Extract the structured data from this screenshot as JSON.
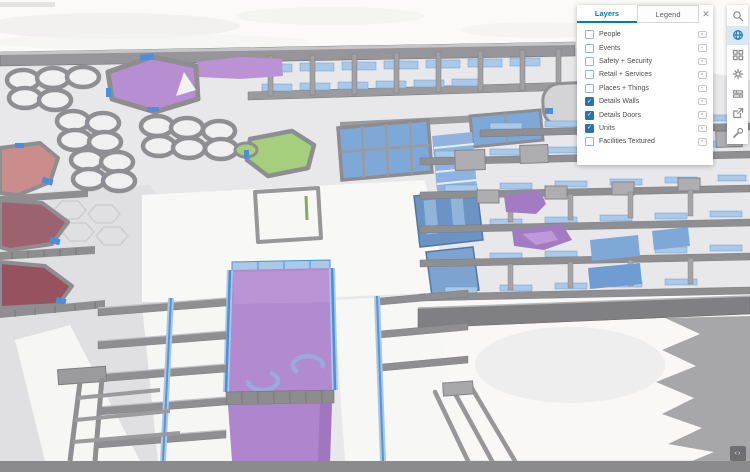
{
  "panel": {
    "tabs": [
      {
        "label": "Layers",
        "active": true
      },
      {
        "label": "Legend",
        "active": false
      }
    ],
    "close_label": "✕",
    "row_icon_name": "layer-options-icon",
    "layers": [
      {
        "label": "People",
        "checked": false
      },
      {
        "label": "Events",
        "checked": false
      },
      {
        "label": "Safety + Security",
        "checked": false
      },
      {
        "label": "Retail + Services",
        "checked": false
      },
      {
        "label": "Places + Things",
        "checked": false
      },
      {
        "label": "Details Walls",
        "checked": true
      },
      {
        "label": "Details Doors",
        "checked": true
      },
      {
        "label": "Units",
        "checked": true
      },
      {
        "label": "Facilities Textured",
        "checked": false
      }
    ]
  },
  "toolbar": {
    "icons": [
      {
        "name": "search",
        "active": false
      },
      {
        "name": "basemap-globe",
        "active": true
      },
      {
        "name": "layout-grid",
        "active": false
      },
      {
        "name": "settings-gear",
        "active": false
      },
      {
        "name": "measure",
        "active": false
      },
      {
        "name": "share-export",
        "active": false
      },
      {
        "name": "tools-wrench",
        "active": false
      }
    ]
  },
  "footer": {
    "widget_glyph": "‹›",
    "widget_icon_name": "attribution-expand-icon"
  },
  "colors": {
    "accent_blue": "#0079c1",
    "checkbox_blue": "#2b72ae",
    "unit_purple": "#b28ad0",
    "unit_green": "#a5ce7d",
    "unit_blue": "#7da8d8",
    "unit_red_salmon": "#cb8c8c",
    "unit_maroon": "#9d6270",
    "wall_gray": "#96969a",
    "glass_blue": "#aac9e8",
    "door_blue": "#4a8fd8",
    "floor_gray": "#e8e8ea",
    "footer_bar_gray": "#8b8b8e"
  }
}
